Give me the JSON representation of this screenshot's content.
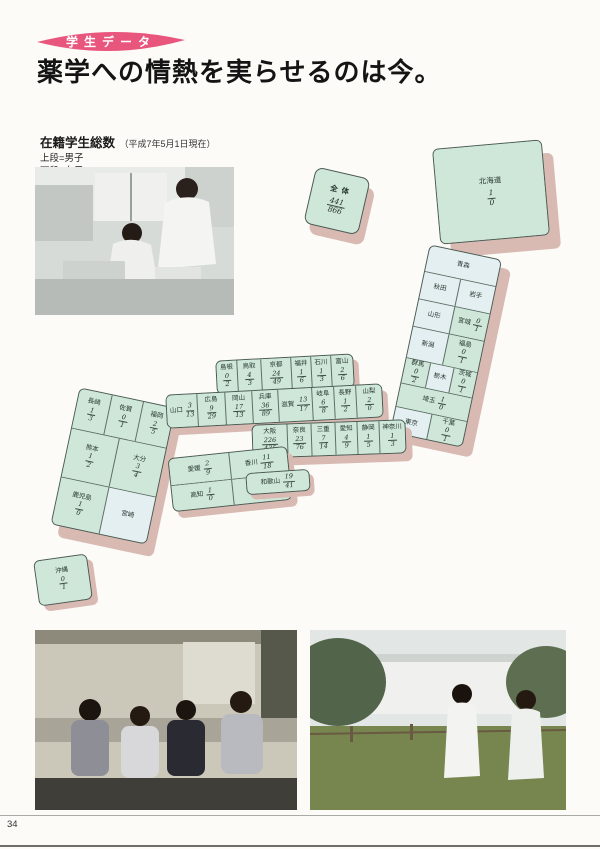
{
  "page_number": "34",
  "header": {
    "badge": "学生データ",
    "title": "薬学への情熱を実らせるのは今。",
    "subtitle": "在籍学生総数",
    "subtitle_note": "（平成7年5月1日現在）",
    "legend_top": "上段=男子",
    "legend_bottom": "下段=女子"
  },
  "colors": {
    "badge_pink": "#e8567d",
    "block_green": "#cfe7d9",
    "block_pale_blue": "#e3eff1",
    "block_side_pink": "#d9bab3"
  },
  "map": {
    "total": {
      "label": "全体",
      "male": "441",
      "female": "866"
    },
    "groups": [
      {
        "id": "hokkaido",
        "cells": [
          {
            "id": "hokkaido",
            "label": "北海道",
            "male": "1",
            "female": "0"
          }
        ]
      },
      {
        "id": "tohoku-kanto",
        "cells": [
          {
            "id": "aomori",
            "label": "青森"
          },
          {
            "id": "akita",
            "label": "秋田"
          },
          {
            "id": "iwate",
            "label": "岩手"
          },
          {
            "id": "yamagata",
            "label": "山形"
          },
          {
            "id": "miyagi",
            "label": "宮城",
            "male": "0",
            "female": "1"
          },
          {
            "id": "niigata",
            "label": "新潟"
          },
          {
            "id": "fukushima",
            "label": "福島",
            "male": "0",
            "female": "1"
          },
          {
            "id": "gunma",
            "label": "群馬",
            "male": "0",
            "female": "2"
          },
          {
            "id": "tochigi",
            "label": "栃木"
          },
          {
            "id": "ibaraki",
            "label": "茨城",
            "male": "0",
            "female": "1"
          },
          {
            "id": "saitama",
            "label": "埼玉",
            "male": "1",
            "female": "0"
          },
          {
            "id": "tokyo",
            "label": "東京"
          },
          {
            "id": "chiba",
            "label": "千葉",
            "male": "0",
            "female": "1"
          }
        ]
      },
      {
        "id": "west-north",
        "cells": [
          {
            "id": "shimane",
            "label": "島根",
            "male": "0",
            "female": "2"
          },
          {
            "id": "tottori",
            "label": "鳥取",
            "male": "4",
            "female": "3"
          },
          {
            "id": "kyoto",
            "label": "京都",
            "male": "24",
            "female": "49"
          },
          {
            "id": "fukui",
            "label": "福井",
            "male": "1",
            "female": "6"
          },
          {
            "id": "ishikawa",
            "label": "石川",
            "male": "1",
            "female": "3"
          },
          {
            "id": "toyama",
            "label": "富山",
            "male": "2",
            "female": "6"
          }
        ]
      },
      {
        "id": "west-mid",
        "cells": [
          {
            "id": "yamaguchi",
            "label": "山口",
            "male": "3",
            "female": "13"
          },
          {
            "id": "hiroshima",
            "label": "広島",
            "male": "9",
            "female": "29"
          },
          {
            "id": "okayama",
            "label": "岡山",
            "male": "17",
            "female": "13"
          },
          {
            "id": "hyogo",
            "label": "兵庫",
            "male": "36",
            "female": "89"
          },
          {
            "id": "shiga",
            "label": "滋賀",
            "male": "13",
            "female": "17"
          },
          {
            "id": "gifu",
            "label": "岐阜",
            "male": "6",
            "female": "8"
          },
          {
            "id": "nagano",
            "label": "長野",
            "male": "1",
            "female": "2"
          },
          {
            "id": "yamanashi",
            "label": "山梨",
            "male": "2",
            "female": "0"
          }
        ]
      },
      {
        "id": "west-south",
        "cells": [
          {
            "id": "osaka",
            "label": "大阪",
            "male": "226",
            "female": "435"
          },
          {
            "id": "nara",
            "label": "奈良",
            "male": "23",
            "female": "76"
          },
          {
            "id": "mie",
            "label": "三重",
            "male": "7",
            "female": "14"
          },
          {
            "id": "aichi",
            "label": "愛知",
            "male": "4",
            "female": "9"
          },
          {
            "id": "shizuoka",
            "label": "静岡",
            "male": "1",
            "female": "5"
          },
          {
            "id": "kanagawa",
            "label": "神奈川",
            "male": "1",
            "female": "3"
          }
        ]
      },
      {
        "id": "wakayama",
        "cells": [
          {
            "id": "wakayama",
            "label": "和歌山",
            "male": "19",
            "female": "41"
          }
        ]
      },
      {
        "id": "shikoku",
        "cells": [
          {
            "id": "ehime",
            "label": "愛媛",
            "male": "2",
            "female": "9"
          },
          {
            "id": "kagawa",
            "label": "香川",
            "male": "11",
            "female": "18"
          },
          {
            "id": "kochi",
            "label": "高知",
            "male": "1",
            "female": "0"
          },
          {
            "id": "tokushima",
            "label": "徳島",
            "male": "3",
            "female": "5"
          }
        ]
      },
      {
        "id": "kyushu",
        "cells": [
          {
            "id": "nagasaki",
            "label": "長崎",
            "male": "1",
            "female": "3"
          },
          {
            "id": "saga",
            "label": "佐賀",
            "male": "0",
            "female": "1"
          },
          {
            "id": "fukuoka",
            "label": "福岡",
            "male": "2",
            "female": "5"
          },
          {
            "id": "kumamoto",
            "label": "熊本",
            "male": "1",
            "female": "2"
          },
          {
            "id": "oita",
            "label": "大分",
            "male": "3",
            "female": "4"
          },
          {
            "id": "kagoshima",
            "label": "鹿児島",
            "male": "1",
            "female": "0"
          },
          {
            "id": "miyazaki",
            "label": "宮崎"
          }
        ]
      },
      {
        "id": "okinawa",
        "cells": [
          {
            "id": "okinawa",
            "label": "沖縄",
            "male": "0",
            "female": "1"
          }
        ]
      }
    ]
  }
}
